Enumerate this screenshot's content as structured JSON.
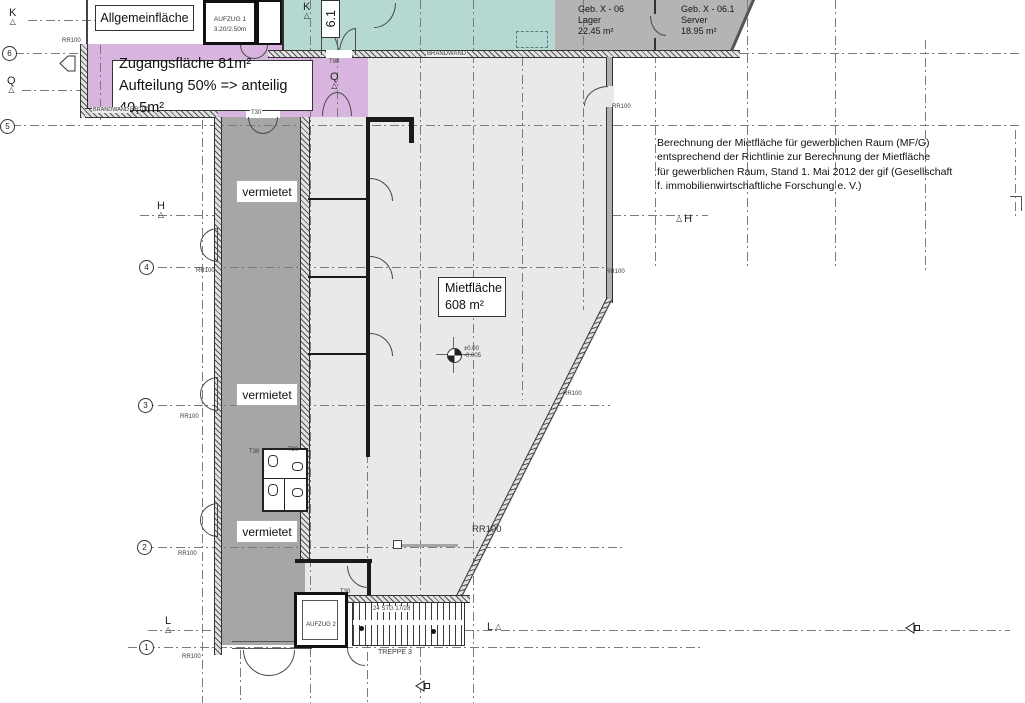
{
  "rooms": {
    "allgemein_label": "Allgemeinfläche",
    "zugang_line1": "Zugangsfläche 81m²",
    "zugang_line2": "Aufteilung 50% => anteilig 40,5m²",
    "miet_line1": "Mietfläche",
    "miet_line2": "608 m²",
    "vermietet_label": "vermietet",
    "lager_name": "Geb. X - 06",
    "lager_use": "Lager",
    "lager_area": "22.45 m²",
    "server_name": "Geb. X - 06.1",
    "server_use": "Server",
    "server_area": "18.95 m²"
  },
  "note": {
    "line1": "Berechnung der Mietfläche für gewerblichen Raum (MF/G)",
    "line2": "entsprechend der Richtlinie zur Berechnung der Mietfläche",
    "line3": "für gewerblichen Raum, Stand 1. Mai 2012 der gif (Gesellschaft",
    "line4": "f. immobilienwirtschaftliche Forschung e. V.)"
  },
  "elements": {
    "aufzug1_name": "AUFZUG 1",
    "aufzug1_size": "3.20/2.50m",
    "aufzug2_name": "AUFZUG 2",
    "treppe_name": "TREPPE 3",
    "treppe_spec": "24 STG 17/28",
    "brandwand": "BRANDWAND",
    "level_top": "±0.00",
    "level_bottom": "-0.005",
    "rr100": "RR100",
    "t30": "T30",
    "t90": "T90",
    "section_61": "6.1"
  },
  "axes": {
    "c6": "6",
    "c5": "5",
    "c4": "4",
    "c3": "3",
    "c2": "2",
    "c1": "1",
    "k": "K",
    "q": "Q",
    "h": "H",
    "l": "L"
  },
  "icons": {
    "axis_arrow": "△"
  },
  "colors": {
    "teal": "#b5d8d2",
    "purple": "#d8b5de",
    "gray_room": "#b4b4b4",
    "dark_strip": "#a6a6a6",
    "mietflaeche_fill": "#e9e9e9"
  }
}
